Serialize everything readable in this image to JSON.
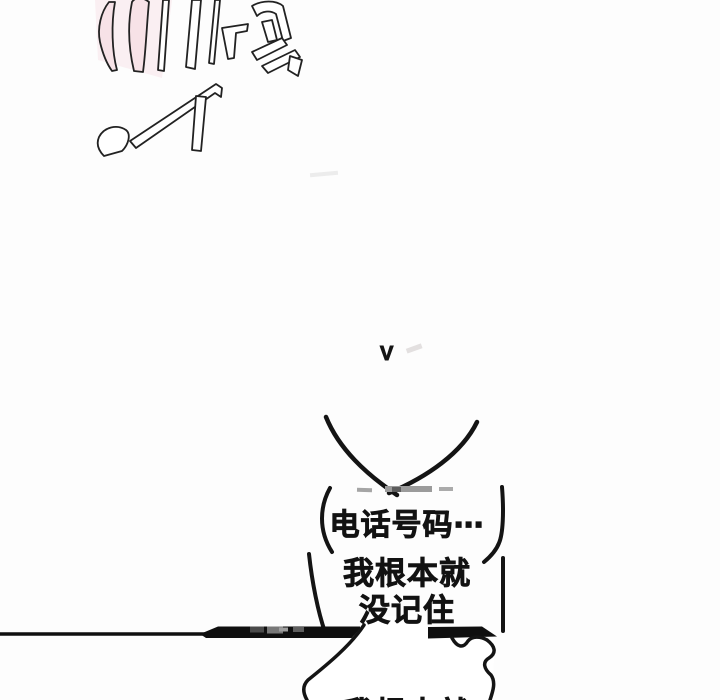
{
  "page": {
    "background": "#fdfdfd",
    "ink": "#121212",
    "sfx_tint_pink": "#f8e4e9",
    "remnant_gray": "#9b9b9b"
  },
  "sfx": {
    "approx_reading": "叮铃",
    "style": "large slanted outline lettering, cropped at top edge",
    "v_mark": "V"
  },
  "bubbles": {
    "phone": {
      "text": "电话号码⋯"
    },
    "memory": {
      "line1": "我根本就",
      "line2": "没记住"
    },
    "bottom_partial": {
      "text": "我根本就"
    }
  }
}
